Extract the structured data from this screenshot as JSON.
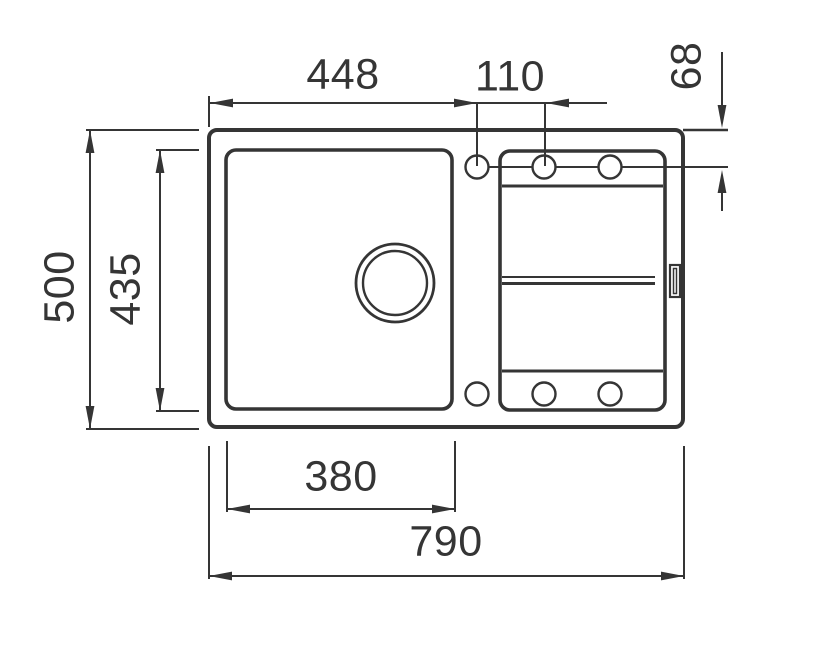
{
  "drawing": {
    "background_color": "#ffffff",
    "line_color": "#353535",
    "dimensions": {
      "rim_left_to_first_hole": "448",
      "hole_spacing": "110",
      "rim_top_to_hole_center": "68",
      "overall_depth": "500",
      "bowl_depth": "435",
      "bowl_width": "380",
      "overall_width": "790"
    }
  }
}
